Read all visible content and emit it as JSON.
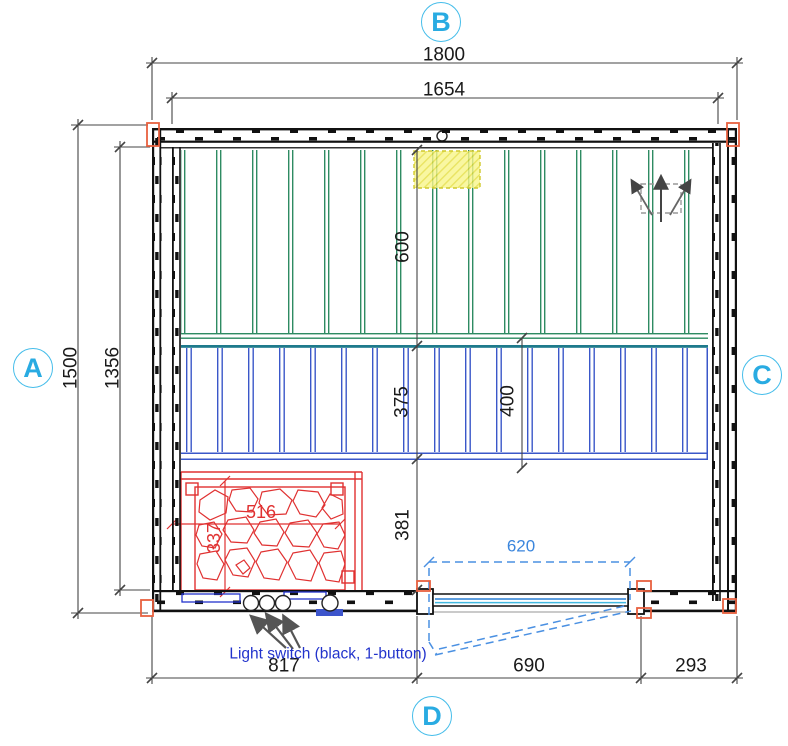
{
  "plan": {
    "side_markers": {
      "left": "A",
      "top": "B",
      "right": "C",
      "bottom": "D"
    },
    "dims": {
      "overall_width": "1800",
      "inner_width": "1654",
      "overall_depth": "1500",
      "inner_depth": "1356",
      "upper_bench_depth": "600",
      "lower_bench_exposed": "375",
      "lower_bench_depth": "400",
      "floor_aisle": "381",
      "heater_width": "516",
      "heater_depth": "337",
      "door_width": "620",
      "seg_left": "817",
      "seg_door": "690",
      "seg_right": "293"
    },
    "notes": {
      "light_switch": "Light switch (black, 1-button)"
    },
    "icons": {
      "airflow": "airflow-direction-arrows",
      "vent": "vent-highlight-hatch",
      "sensor": "ceiling-sensor-circle"
    },
    "colors": {
      "accent_cyan": "#29ABE2",
      "bench_upper_green": "#2E8B62",
      "bench_lower_blue": "#3A57C9",
      "bench_edge_teal": "#1E7A8C",
      "heater_red": "#E03131",
      "dim_black": "#1A1A1A",
      "dim_blue": "#4A90E2",
      "note_blue": "#2233CC",
      "highlight_yellow": "#F5F07A",
      "corner_marker_orange": "#E8603F",
      "arrow_gray": "#555555"
    }
  }
}
